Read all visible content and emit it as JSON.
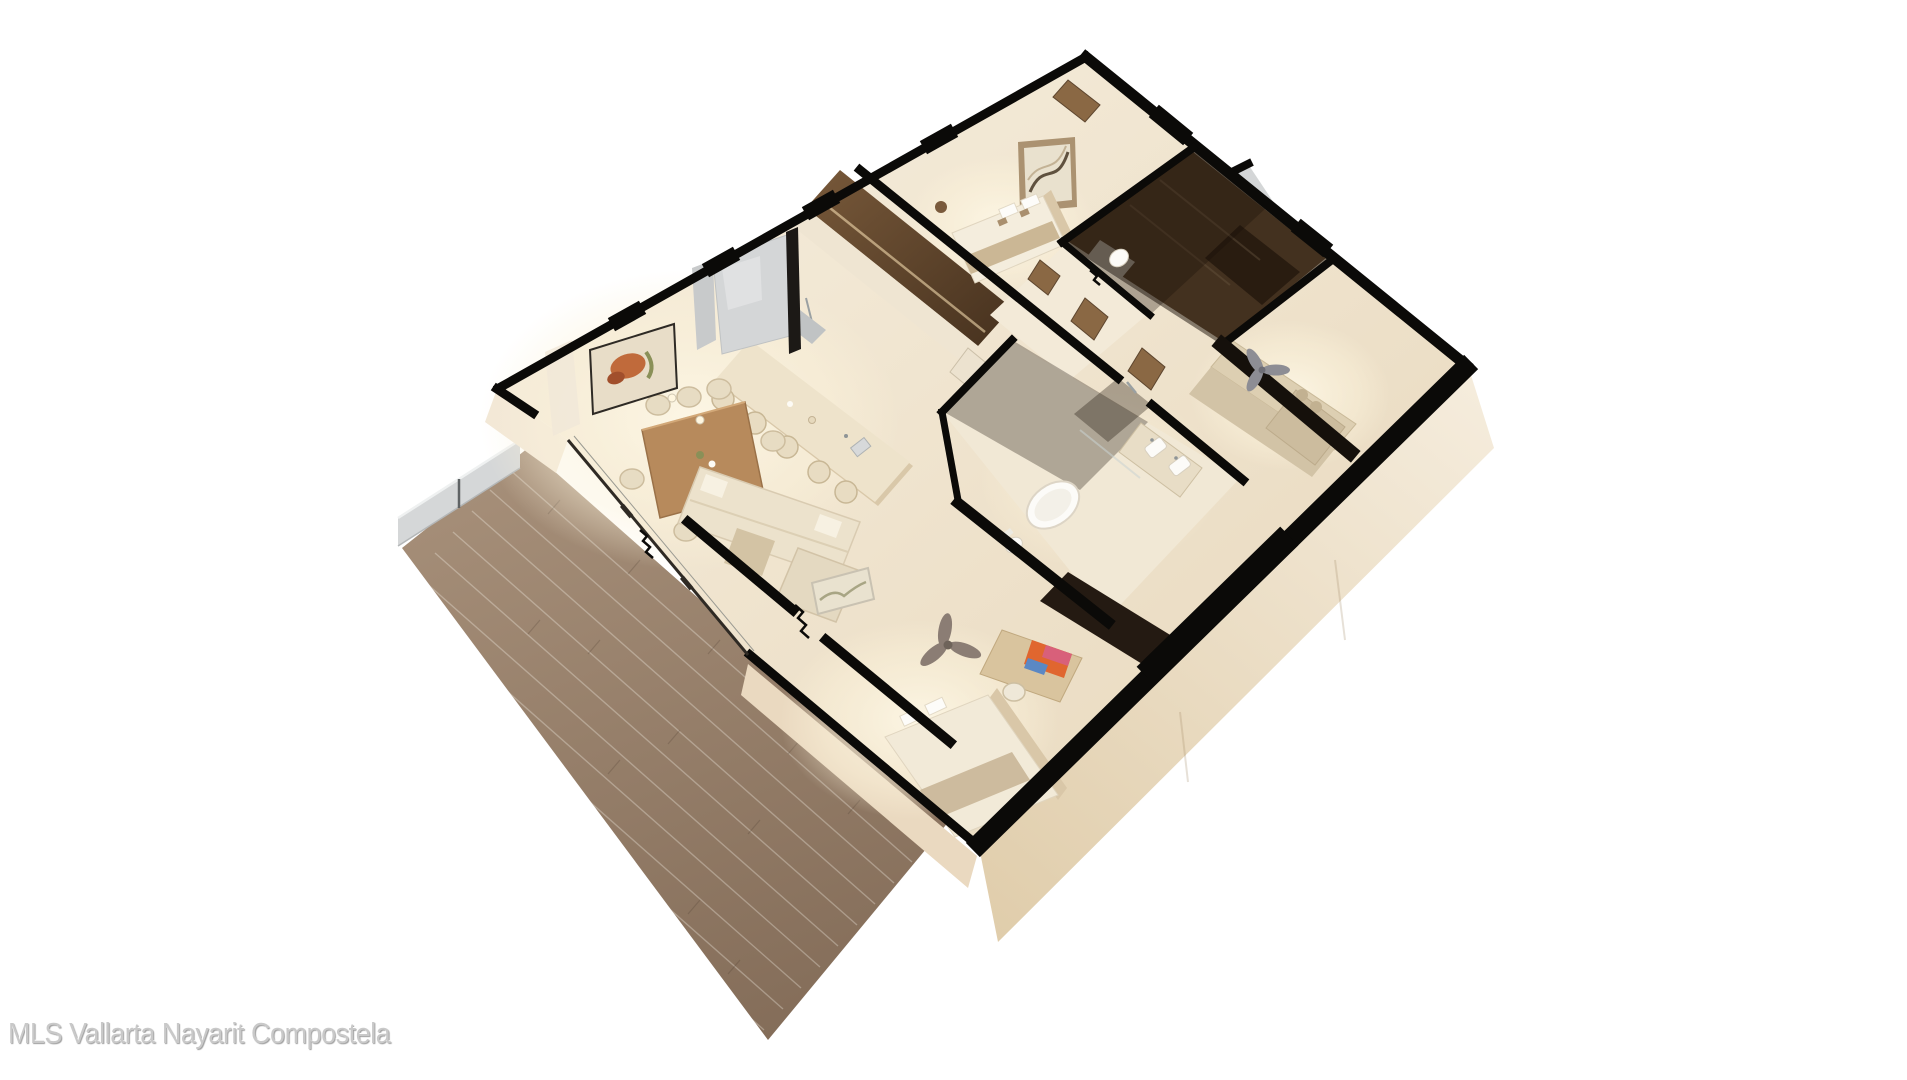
{
  "meta": {
    "type": "3d-floorplan-render",
    "subject": "Cutaway isometric 3D render of a two-bedroom apartment: open kitchen with island and dining for eight, living sofa, two bedrooms, two bathrooms with freestanding tub and double vanity, den with sofa, ceiling fans, walk-in closet, glass railing and large wood-deck terrace"
  },
  "watermark": {
    "text": "MLS Vallarta Nayarit Compostela"
  },
  "colors": {
    "background": "#ffffff",
    "wall-cut": "#0b0a08",
    "floor-warm": "#f3e9d4",
    "floor-shadow": "#e6d6ba",
    "exterior-wall": "#f0e4d1",
    "deck-wood": "#9d8671",
    "deck-wood-dark": "#846d59",
    "glass-railing": "#d5d7d8",
    "glass-pane": "#d4d6d7",
    "dark-wood": "#5f482f",
    "mid-wood": "#8a6844",
    "table-wood": "#b78a5c",
    "upholstery": "#ece2cc",
    "den-upholstery": "#d8caae",
    "fixture-white": "#fcfbf8",
    "fan-gray": "#8b7d74",
    "tint-glass": "rgba(24,14,6,0.45)",
    "art-orange": "#c06a3b",
    "art-green": "#8a9058",
    "watermark-gray": "#c9c9c9"
  }
}
